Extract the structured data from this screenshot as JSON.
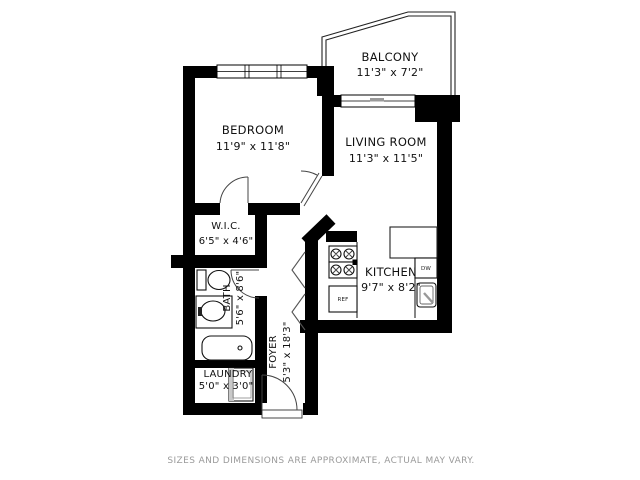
{
  "plan": {
    "rooms": [
      {
        "name": "BALCONY",
        "dims": "11'3\" x 7'2\""
      },
      {
        "name": "BEDROOM",
        "dims": "11'9\" x 11'8\""
      },
      {
        "name": "LIVING ROOM",
        "dims": "11'3\" x 11'5\""
      },
      {
        "name": "W.I.C.",
        "dims": "6'5\" x 4'6\""
      },
      {
        "name": "KITCHEN",
        "dims": "9'7\" x 8'2\""
      },
      {
        "name": "BATH",
        "dims": "5'6\" x 8'6\""
      },
      {
        "name": "FOYER",
        "dims": "5'3\" x 18'3\""
      },
      {
        "name": "LAUNDRY",
        "dims": "5'0\" x 3'0\""
      }
    ],
    "appliances": {
      "refrigerator": "REF",
      "dishwasher": "DW"
    },
    "disclaimer": "SIZES AND DIMENSIONS ARE APPROXIMATE, ACTUAL MAY VARY.",
    "colors": {
      "wall": "#000000",
      "text": "#111111",
      "disclaimer": "#9a9a9a"
    }
  }
}
